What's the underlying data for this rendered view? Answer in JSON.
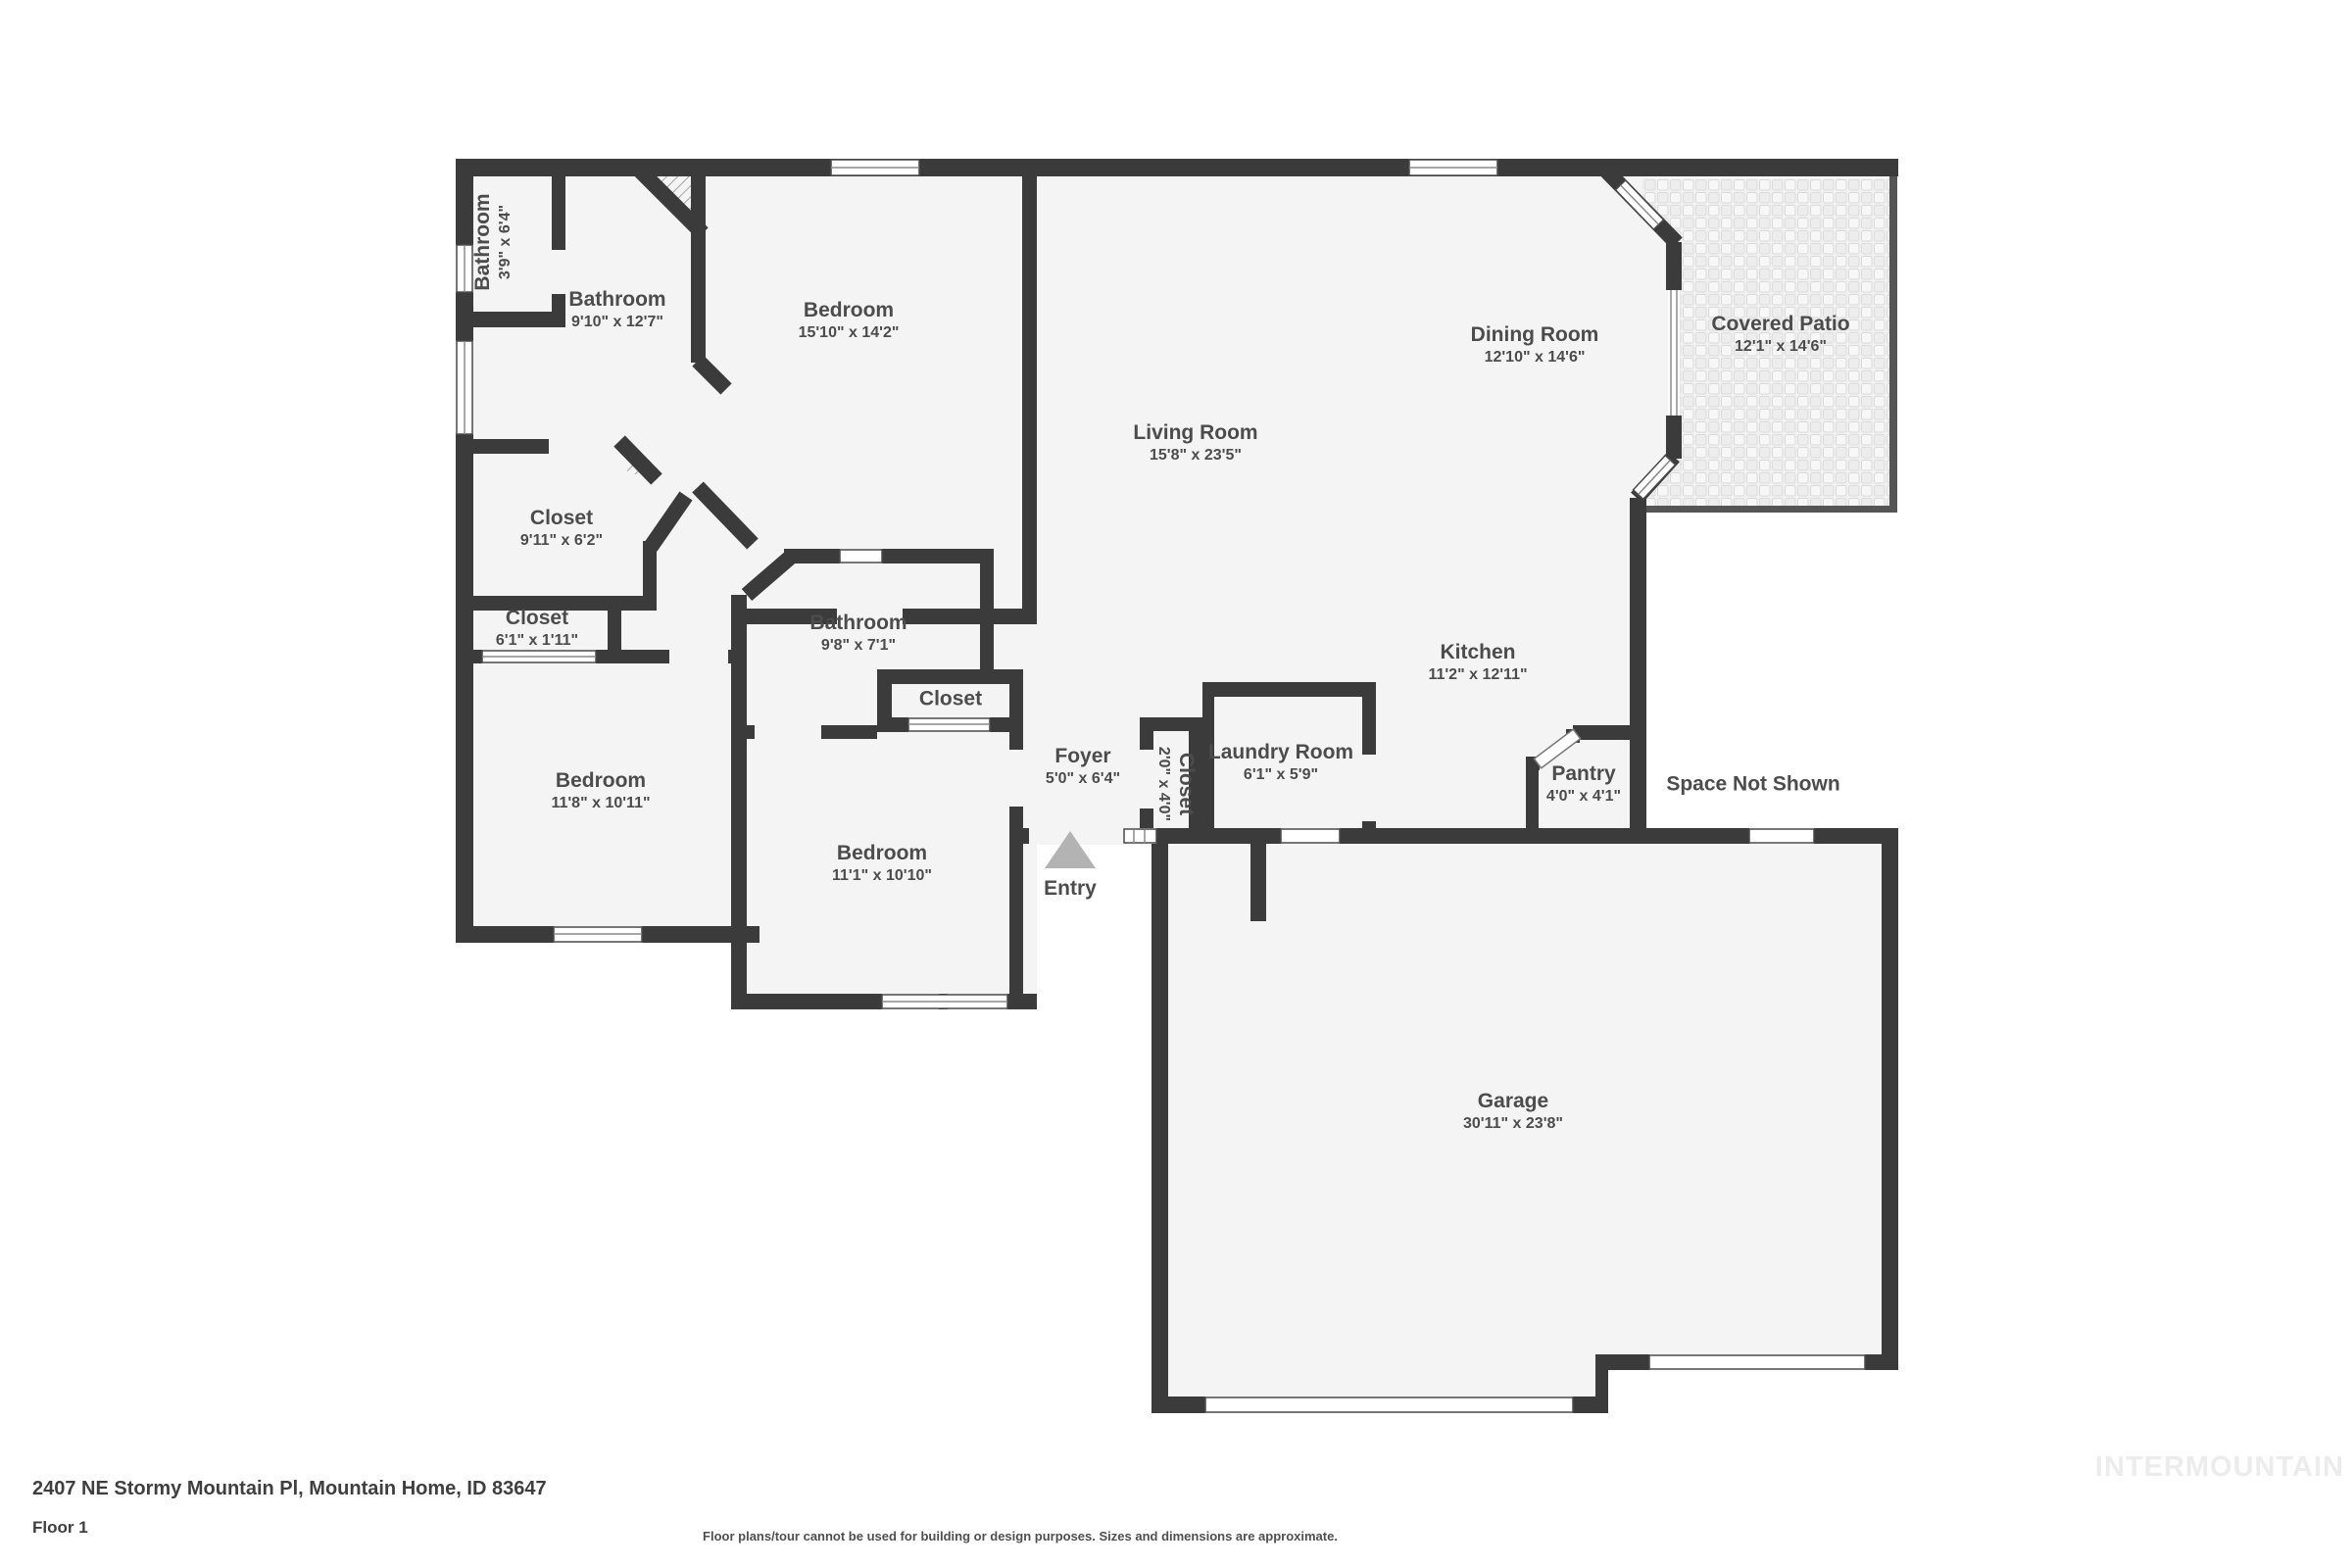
{
  "floor_plan": {
    "rooms": [
      {
        "name": "Bathroom",
        "dims": "3'9\" x 6'4\""
      },
      {
        "name": "Bathroom",
        "dims": "9'10\" x 12'7\""
      },
      {
        "name": "Bedroom",
        "dims": "15'10\" x 14'2\""
      },
      {
        "name": "Dining Room",
        "dims": "12'10\" x 14'6\""
      },
      {
        "name": "Covered Patio",
        "dims": "12'1\" x 14'6\""
      },
      {
        "name": "Living Room",
        "dims": "15'8\" x 23'5\""
      },
      {
        "name": "Closet",
        "dims": "9'11\" x 6'2\""
      },
      {
        "name": "Closet",
        "dims": "6'1\" x 1'11\""
      },
      {
        "name": "Bathroom",
        "dims": "9'8\" x 7'1\""
      },
      {
        "name": "Closet"
      },
      {
        "name": "Kitchen",
        "dims": "11'2\" x 12'11\""
      },
      {
        "name": "Bedroom",
        "dims": "11'8\" x 10'11\""
      },
      {
        "name": "Foyer",
        "dims": "5'0\" x 6'4\""
      },
      {
        "name": "Closet",
        "dims": "2'0\" x 4'0\""
      },
      {
        "name": "Laundry Room",
        "dims": "6'1\" x 5'9\""
      },
      {
        "name": "Pantry",
        "dims": "4'0\" x 4'1\""
      },
      {
        "name": "Space Not Shown"
      },
      {
        "name": "Bedroom",
        "dims": "11'1\" x 10'10\""
      },
      {
        "name": "Garage",
        "dims": "30'11\" x 23'8\""
      }
    ],
    "entry_label": "Entry",
    "colors": {
      "wall": "#3b3b3b",
      "floor": "#f4f4f4",
      "label_text": "#4c4c4c",
      "entry_triangle": "#b3b3b3",
      "patio_tile_line": "#d9d9d9"
    }
  },
  "footer": {
    "address": "2407 NE Stormy Mountain Pl, Mountain Home, ID 83647",
    "floor_label": "Floor 1",
    "disclaimer": "Floor plans/tour cannot be used for building or design purposes. Sizes and dimensions are approximate.",
    "watermark": "INTERMOUNTAIN"
  }
}
